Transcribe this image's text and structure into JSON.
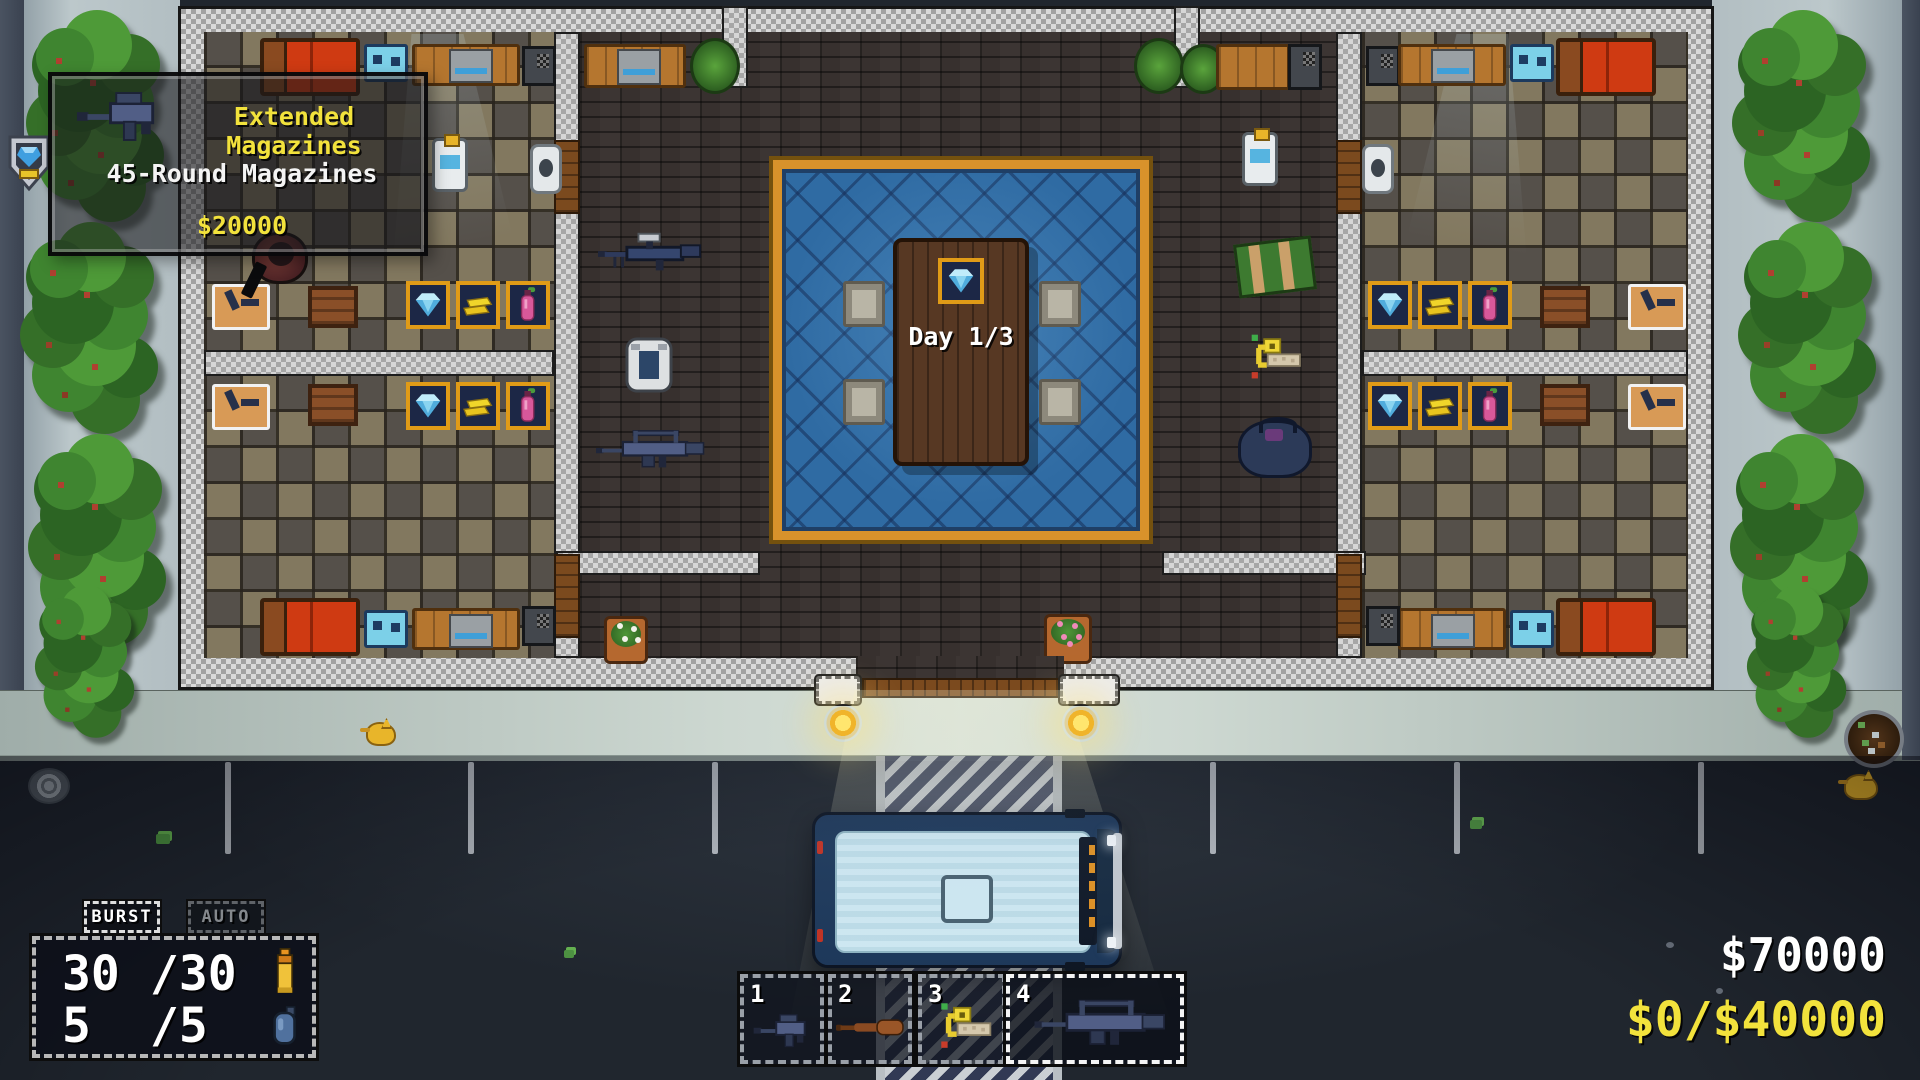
{
  "tooltip": {
    "title": "Extended Magazines",
    "subtitle": "45-Round Magazines",
    "price": "$20000",
    "icon": "smg-extended-magazine"
  },
  "world": {
    "day_label": "Day 1/3",
    "table_marker_icon": "diamond",
    "edge_marker_icon": "shield-gem",
    "shop_display_items": [
      "diamond",
      "gold-bars",
      "bottle"
    ],
    "floor_items_left": [
      "sniper-rifle",
      "armor-vest",
      "assault-rifle"
    ],
    "floor_items_right": [
      "ammo-crate",
      "breaching-charge",
      "duffel-bag"
    ],
    "vehicle": "van",
    "animals": [
      "cat",
      "cat",
      "cat"
    ]
  },
  "hud": {
    "fire_modes": [
      {
        "label": "BURST",
        "active": true
      },
      {
        "label": "AUTO",
        "active": false
      }
    ],
    "ammo": {
      "magazine": "30",
      "magazine_max": "/30",
      "magazine_icon": "rifle-round",
      "reserve": "5",
      "reserve_max": "/5",
      "reserve_icon": "grenade"
    },
    "hotbar": {
      "slots": [
        {
          "key": "1",
          "item": "smg",
          "selected": false
        },
        {
          "key": "2",
          "item": "baseball-bat",
          "selected": false
        },
        {
          "key": "3",
          "item": "breaching-charge",
          "selected": false
        },
        {
          "key": "4",
          "item": "battle-rifle",
          "selected": true
        }
      ]
    },
    "money": {
      "balance": "$70000",
      "objective_progress": "$0/$40000"
    }
  },
  "colors": {
    "accent_yellow": "#f2e23c",
    "money_white": "#ffffff",
    "shop_frame_orange": "#e09b17",
    "carpet_blue": "#2f6ba3",
    "road_navy": "#27304e",
    "wall_gray": "#c0c0c0",
    "tree_green": "#3f8530"
  }
}
